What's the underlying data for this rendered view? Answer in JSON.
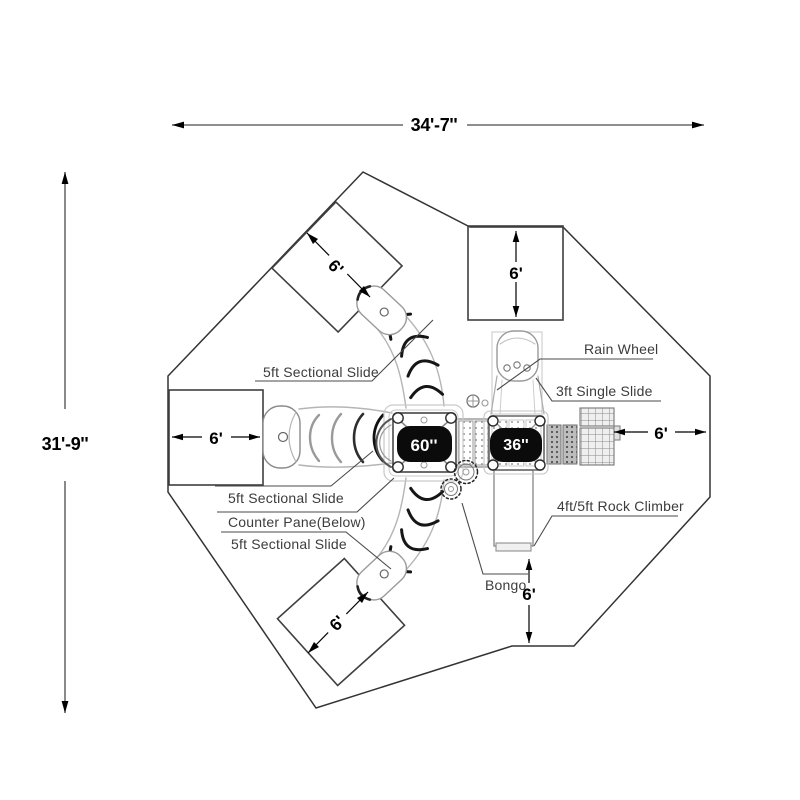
{
  "drawing": {
    "overall_width": "34'-7''",
    "overall_height": "31'-9''",
    "decks": {
      "deck_large": "60''",
      "deck_small": "36''"
    },
    "clearances": {
      "top_square": "6'",
      "left_square": "6'",
      "upper_diamond": "6'",
      "lower_diamond": "6'",
      "right": "6'",
      "bottom": "6'"
    },
    "labels": {
      "slide_upper": "5ft Sectional Slide",
      "rain_wheel": "Rain Wheel",
      "single_slide": "3ft Single Slide",
      "slide_left": "5ft Sectional Slide",
      "counter_pane": "Counter Pane(Below)",
      "slide_lower": "5ft Sectional Slide",
      "rock_climber": "4ft/5ft Rock Climber",
      "bongo": "Bongo"
    },
    "colors": {
      "ink": "#000000",
      "label_text": "#3c3c3c",
      "border": "#333333",
      "equipment_light": "#b5b5b5",
      "equipment_mid": "#8a8a8a",
      "deck_badge_bg": "#0b0b0b",
      "deck_badge_text": "#ffffff",
      "background": "#ffffff"
    }
  }
}
